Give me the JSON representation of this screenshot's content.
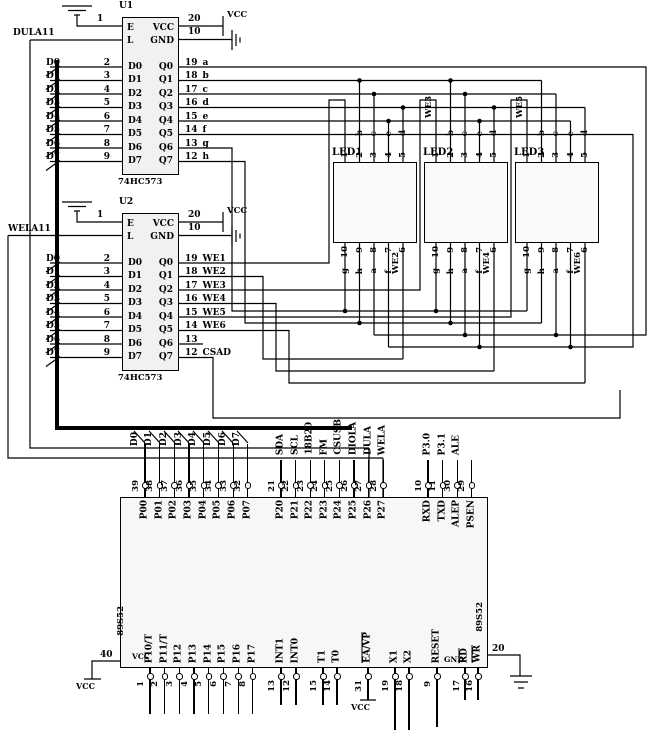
{
  "latches": {
    "u1": {
      "ref": "U1",
      "part": "74HC573",
      "pin1": "1",
      "latch_label": "DULA11",
      "power": {
        "e": "E",
        "vcc": "VCC",
        "l": "L",
        "gnd": "GND",
        "vcc_pin": "20",
        "gnd_pin": "10",
        "vcc_text": "VCC"
      },
      "rows": [
        {
          "din": "D0",
          "dpin": "2",
          "qout": "Q0",
          "qpin": "19",
          "net": "a"
        },
        {
          "din": "D1",
          "dpin": "3",
          "qout": "Q1",
          "qpin": "18",
          "net": "b"
        },
        {
          "din": "D2",
          "dpin": "4",
          "qout": "Q2",
          "qpin": "17",
          "net": "c"
        },
        {
          "din": "D3",
          "dpin": "5",
          "qout": "Q3",
          "qpin": "16",
          "net": "d"
        },
        {
          "din": "D4",
          "dpin": "6",
          "qout": "Q4",
          "qpin": "15",
          "net": "e"
        },
        {
          "din": "D5",
          "dpin": "7",
          "qout": "Q5",
          "qpin": "14",
          "net": "f"
        },
        {
          "din": "D6",
          "dpin": "8",
          "qout": "Q6",
          "qpin": "13",
          "net": "g"
        },
        {
          "din": "D7",
          "dpin": "9",
          "qout": "Q7",
          "qpin": "12",
          "net": "h"
        }
      ]
    },
    "u2": {
      "ref": "U2",
      "part": "74HC573",
      "pin1": "1",
      "latch_label": "WELA11",
      "power": {
        "e": "E",
        "vcc": "VCC",
        "l": "L",
        "gnd": "GND",
        "vcc_pin": "20",
        "gnd_pin": "10",
        "vcc_text": "VCC"
      },
      "rows": [
        {
          "din": "D0",
          "dpin": "2",
          "qout": "Q0",
          "qpin": "19",
          "net": "WE1"
        },
        {
          "din": "D1",
          "dpin": "3",
          "qout": "Q1",
          "qpin": "18",
          "net": "WE2"
        },
        {
          "din": "D2",
          "dpin": "4",
          "qout": "Q2",
          "qpin": "17",
          "net": "WE3"
        },
        {
          "din": "D3",
          "dpin": "5",
          "qout": "Q3",
          "qpin": "16",
          "net": "WE4"
        },
        {
          "din": "D4",
          "dpin": "6",
          "qout": "Q4",
          "qpin": "15",
          "net": "WE5"
        },
        {
          "din": "D5",
          "dpin": "7",
          "qout": "Q5",
          "qpin": "14",
          "net": "WE6"
        },
        {
          "din": "D6",
          "dpin": "8",
          "qout": "Q6",
          "qpin": "13",
          "net": ""
        },
        {
          "din": "D7",
          "dpin": "9",
          "qout": "Q7",
          "qpin": "12",
          "net": "CSAD"
        }
      ]
    }
  },
  "displays": [
    {
      "name": "LED1",
      "sel_top": "WE1",
      "sel_bottom": "WE2",
      "top_pins": [
        "1",
        "2",
        "3",
        "4",
        "5"
      ],
      "top_nets": [
        "b",
        "c",
        "e",
        "d"
      ],
      "bottom_pins": [
        "10",
        "9",
        "8",
        "7",
        "6"
      ],
      "bottom_nets": [
        "g",
        "h",
        "a",
        "f"
      ]
    },
    {
      "name": "LED2",
      "sel_top": "WE3",
      "sel_bottom": "WE4",
      "top_pins": [
        "1",
        "2",
        "3",
        "4",
        "5"
      ],
      "top_nets": [
        "b",
        "c",
        "e",
        "d"
      ],
      "bottom_pins": [
        "10",
        "9",
        "8",
        "7",
        "6"
      ],
      "bottom_nets": [
        "g",
        "h",
        "a",
        "f"
      ]
    },
    {
      "name": "LED3",
      "sel_top": "WE5",
      "sel_bottom": "WE6",
      "top_pins": [
        "1",
        "2",
        "3",
        "4",
        "5"
      ],
      "top_nets": [
        "b",
        "c",
        "e",
        "d"
      ],
      "bottom_pins": [
        "10",
        "9",
        "8",
        "7",
        "6"
      ],
      "bottom_nets": [
        "g",
        "h",
        "a",
        "f"
      ]
    }
  ],
  "mcu": {
    "ref_left": "89S52",
    "ref_right": "89S52",
    "p0_pins": [
      {
        "bus": "D0",
        "num": "39",
        "port": "P00"
      },
      {
        "bus": "D1",
        "num": "38",
        "port": "P01"
      },
      {
        "bus": "D2",
        "num": "37",
        "port": "P02"
      },
      {
        "bus": "D3",
        "num": "36",
        "port": "P03"
      },
      {
        "bus": "D4",
        "num": "35",
        "port": "P04"
      },
      {
        "bus": "D5",
        "num": "34",
        "port": "P05"
      },
      {
        "bus": "D6",
        "num": "33",
        "port": "P06"
      },
      {
        "bus": "D7",
        "num": "32",
        "port": "P07"
      }
    ],
    "p2_pins": [
      {
        "sig": "SDA",
        "num": "21",
        "port": "P20"
      },
      {
        "sig": "SCL",
        "num": "22",
        "port": "P21"
      },
      {
        "sig": "18B20",
        "num": "23",
        "port": "P22"
      },
      {
        "sig": "FM",
        "num": "24",
        "port": "P23"
      },
      {
        "sig": "CSUSB",
        "num": "25",
        "port": "P24"
      },
      {
        "sig": "DIOLA",
        "num": "26",
        "port": "P25"
      },
      {
        "sig": "DULA",
        "num": "27",
        "port": "P26"
      },
      {
        "sig": "WELA",
        "num": "28",
        "port": "P27"
      }
    ],
    "p3_pins": [
      {
        "sig": "P3.0",
        "num": "10",
        "port": "RXD"
      },
      {
        "sig": "P3.1",
        "num": "11",
        "port": "TXD"
      },
      {
        "sig": "ALE",
        "num": "30",
        "port": "ALEP"
      },
      {
        "sig": "",
        "num": "29",
        "port": "PSEN"
      }
    ],
    "bottom_a": [
      {
        "port": "P10/T",
        "num": "1"
      },
      {
        "port": "P11/T",
        "num": "2"
      },
      {
        "port": "P12",
        "num": "3"
      },
      {
        "port": "P13",
        "num": "4"
      },
      {
        "port": "P14",
        "num": "5"
      },
      {
        "port": "P15",
        "num": "6"
      },
      {
        "port": "P16",
        "num": "7"
      },
      {
        "port": "P17",
        "num": "8"
      }
    ],
    "bottom_int": [
      {
        "port": "INT1",
        "num": "13"
      },
      {
        "port": "INT0",
        "num": "12"
      }
    ],
    "bottom_t": [
      {
        "port": "T1",
        "num": "15"
      },
      {
        "port": "T0",
        "num": "14"
      }
    ],
    "bottom_ea": [
      {
        "port": "EA/VP",
        "num": "31"
      }
    ],
    "bottom_x": [
      {
        "port": "X1",
        "num": "19"
      },
      {
        "port": "X2",
        "num": "18"
      }
    ],
    "bottom_reset": [
      {
        "port": "RESET",
        "num": "9"
      }
    ],
    "bottom_rw": [
      {
        "port": "RD",
        "num": "17"
      },
      {
        "port": "WR",
        "num": "16"
      }
    ],
    "pin40": "40",
    "gnd_pin": "20",
    "gnd_label": "GND",
    "vcc_inner": "VCC",
    "vcc_left": "VCC",
    "vcc_ea": "VCC"
  }
}
